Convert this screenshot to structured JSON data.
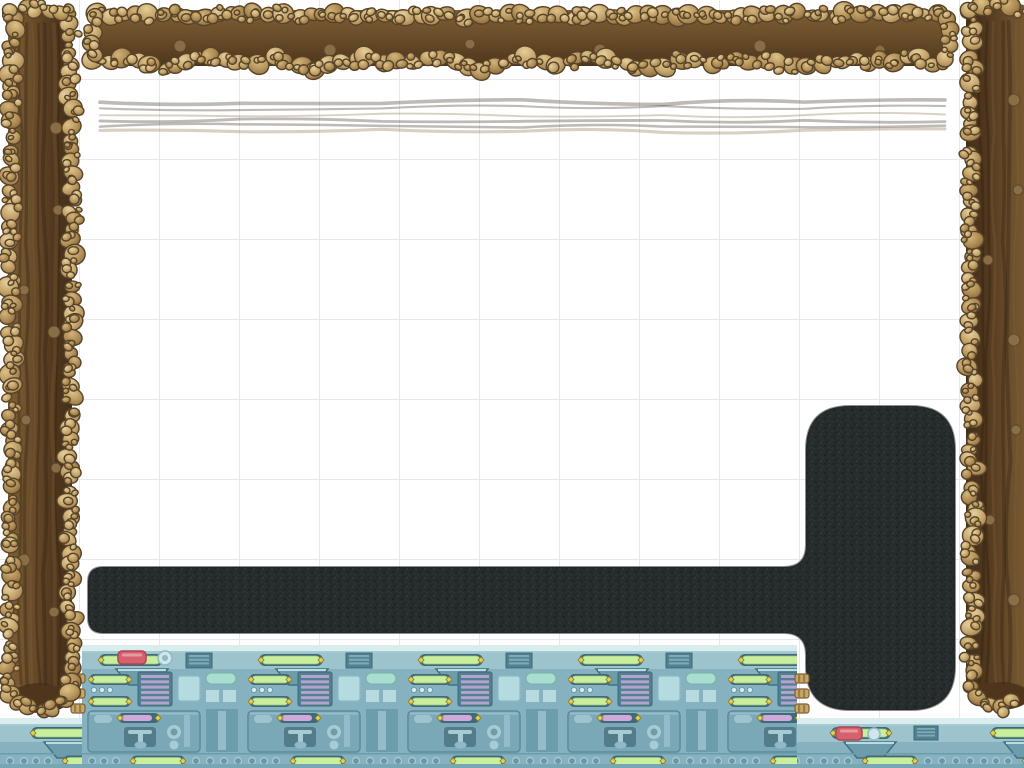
{
  "scene": {
    "title": "physics-building-game-level",
    "viewport": {
      "width": 1024,
      "height": 768
    },
    "grid": {
      "cell_px": 80,
      "line_color": "#e8e8e8",
      "background": "#ffffff"
    },
    "palette": {
      "pebble_light": "#e6cf9a",
      "pebble_mid": "#c5a56c",
      "pebble_dark": "#96774b",
      "pebble_outline": "#564329",
      "dirt_core_dark": "#4e351c",
      "dirt_core_mid": "#6b4e2b",
      "dirt_band": "#7e5e35",
      "dirt_grain_dark": "#382613",
      "dirt_stone": "#8c7048",
      "path_base": "#262b2c",
      "path_speck_light": "#3a4142",
      "path_speck_dark": "#141819",
      "mach_rail": "#d9edef",
      "mach_band": "#9dc3cd",
      "mach_base": "#86b2c0",
      "mach_panel": "#7ba8b6",
      "mach_dark": "#6d9cab",
      "mach_slot": "#40697a",
      "mach_window": "#51808f",
      "mach_stripe": "#7fa9b8",
      "mach_screen": "#b5dbe1",
      "mach_light_line": "#a9ccd4",
      "mach_pipe": "#93bcc8",
      "mach_shade": "#79a6b4",
      "green_light": "#c9ee9e",
      "yellow_cap": "#e2cf58",
      "red_button": "#d6606b",
      "red_button_dark": "#a84852",
      "purple_stripe": "#b4a3ce",
      "pink_capsule": "#cfa9d9",
      "teal_capsule": "#a8ddcf",
      "gold_pipe": "#c8a868",
      "gold_pipe_dark": "#7d5f33"
    },
    "objects": {
      "dirt_border_left": {
        "x": 0,
        "y": 0,
        "w": 82,
        "h": 714
      },
      "dirt_border_top": {
        "x": 84,
        "y": 4,
        "w": 872,
        "h": 74
      },
      "dirt_border_right": {
        "x": 958,
        "y": 0,
        "w": 66,
        "h": 710
      },
      "rock_path": {
        "hbar": {
          "x": 88,
          "y_top": 567,
          "y_bottom": 633,
          "x_end": 806,
          "corner_r": 15
        },
        "vbar": {
          "x1": 806,
          "x2": 955,
          "y_top": 406,
          "y_bottom": 710,
          "corner_r": 44
        },
        "fillet_r": 22
      },
      "machine_platform_main": {
        "x": 82,
        "y": 645,
        "w": 715,
        "h": 123
      },
      "machine_platform_bottom": {
        "x": 0,
        "y": 718,
        "w": 1024,
        "h": 50
      },
      "machine_tile_period_px": 160
    }
  }
}
